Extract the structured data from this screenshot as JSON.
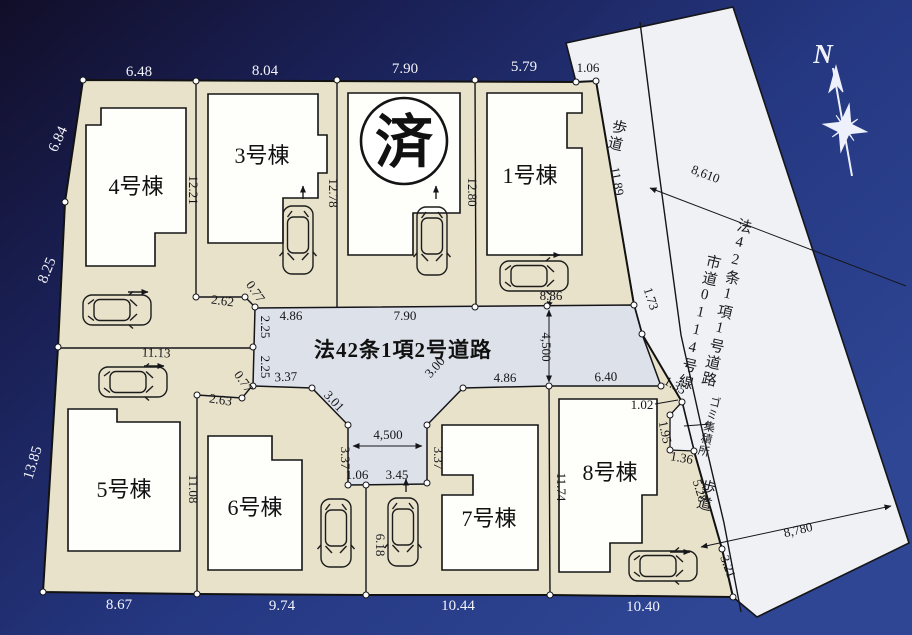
{
  "compass": {
    "north": "N"
  },
  "buildings": {
    "b1": "1号棟",
    "b3": "3号棟",
    "b4": "4号棟",
    "b5": "5号棟",
    "b6": "6号棟",
    "b7": "7号棟",
    "b8": "8号棟",
    "sold_mark": "済"
  },
  "roads": {
    "center": "法42条1項2号道路",
    "right_main": "法42条1項1号道路",
    "right_city": "市道0114号線",
    "sidewalk_top": "歩道",
    "sidewalk_bottom": "歩道",
    "garbage": "ゴミ集積所"
  },
  "dims": {
    "top": [
      "6.48",
      "8.04",
      "7.90",
      "5.79",
      "1.06"
    ],
    "left": [
      "6.84",
      "8.25",
      "13.85"
    ],
    "bottom": [
      "8.67",
      "9.74",
      "10.44",
      "10.40"
    ],
    "lot4_depth": "12.21",
    "lot3_depth": "12.78",
    "lot2_depth": "12.80",
    "lot1_side": "11.89",
    "lot1_front": "8.86",
    "jog_2_62": "2.62",
    "jog_0_77_top": "0.77",
    "road_4_86_w": "4.86",
    "road_7_90": "7.90",
    "road_2_25_a": "2.25",
    "road_2_25_b": "2.25",
    "jog_0_77_bottom": "0.77",
    "jog_2_63": "2.63",
    "road_3_37": "3.37",
    "slant_3_01": "3.01",
    "slant_3_00": "3.00",
    "road_4_86_e": "4.86",
    "road_6_40": "6.40",
    "stub_width": "4,500",
    "stub_side_w": "3.37",
    "stub_side_e": "3.37",
    "stub_1_06": "1.06",
    "stub_3_45": "3.45",
    "road_width": "4,500",
    "side_1_73": "1.73",
    "lot5_top": "11.13",
    "lot56_depth": "11.08",
    "lot67_depth": "6.18",
    "lot78_depth": "11.74",
    "g_1_35": "1.35",
    "g_1_02": "1.02",
    "g_1_95": "1.95",
    "g_1_36": "1.36",
    "sw_5_28": "5.28",
    "sw_3_21": "3.21",
    "road_8610": "8,610",
    "road_8780": "8,780"
  }
}
